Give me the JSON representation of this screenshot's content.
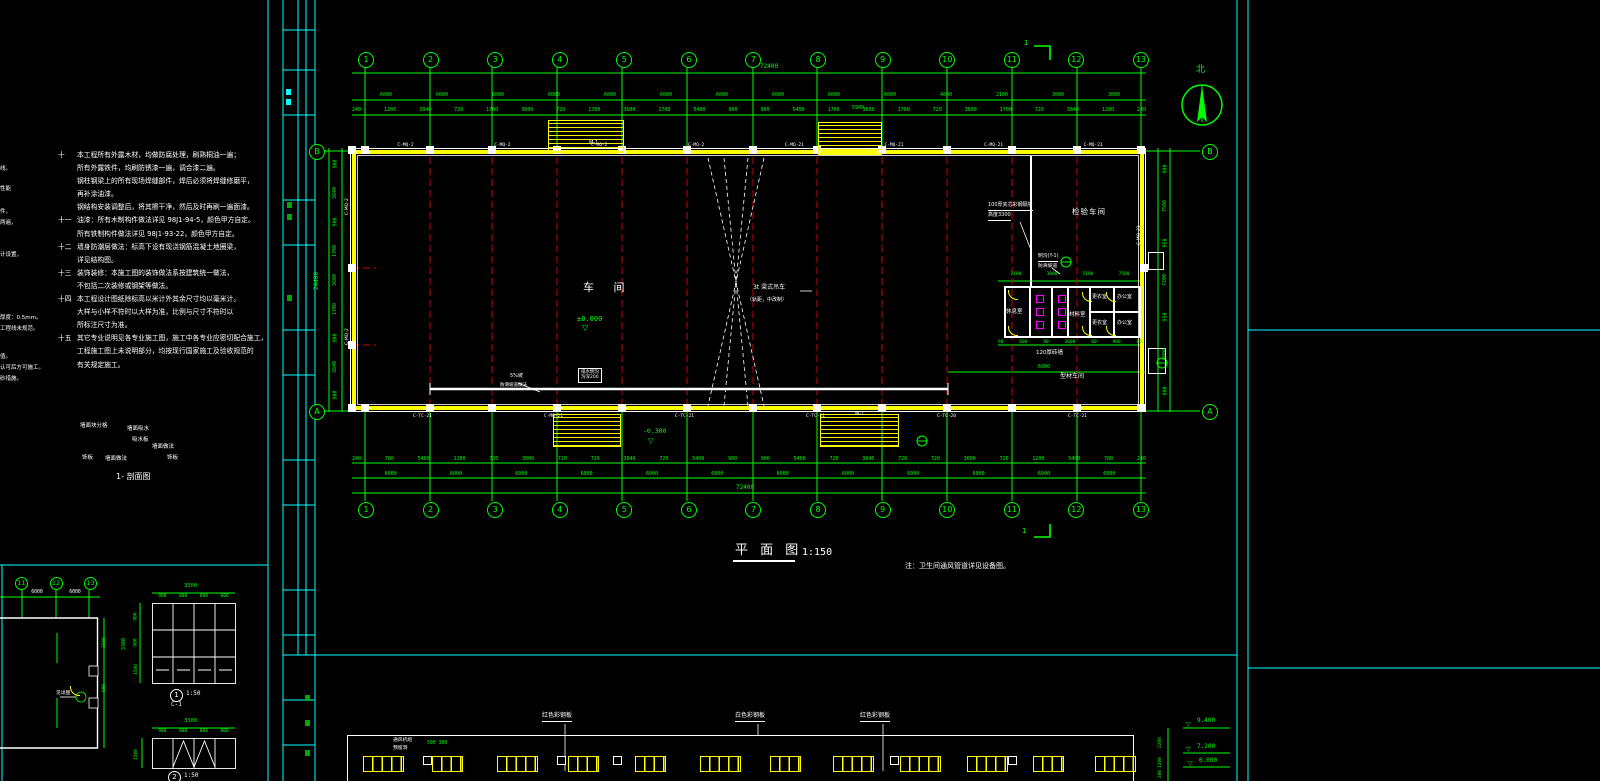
{
  "notes": [
    {
      "n": "十",
      "t": "本工程所有外露木材，均做防腐处理，刷熟桐油一遍；"
    },
    {
      "n": "",
      "t": "所有外露铁件，均刷防锈漆一遍，调合漆二遍。"
    },
    {
      "n": "",
      "t": "钢柱钢梁上的所有现场焊缝部件，焊后必须将焊缝修磨平，"
    },
    {
      "n": "",
      "t": "再补涂油漆。"
    },
    {
      "n": "",
      "t": "钢结构安装调整后，将其擦干净，然后及时再刷一遍面漆。"
    },
    {
      "n": "十一",
      "t": "油漆：所有木制构件做法详见 98J1-94-5，颜色甲方自定。"
    },
    {
      "n": "",
      "t": "所有铁制构件做法详见 98J1-93-22，颜色甲方自定。"
    },
    {
      "n": "十二",
      "t": "墙身防潮层做法：标高下设有现浇钢筋混凝土地圈梁，"
    },
    {
      "n": "",
      "t": "详见结构图。"
    },
    {
      "n": "十三",
      "t": "装饰装修：本施工图的装饰做法系按建筑统一做法，"
    },
    {
      "n": "",
      "t": "不包括二次装修或钢架等做法。"
    },
    {
      "n": "十四",
      "t": "本工程设计图纸除标高以米计外其余尺寸均以毫米计。"
    },
    {
      "n": "",
      "t": "大样与小样不符时以大样为准，比例与尺寸不符时以"
    },
    {
      "n": "",
      "t": "所标注尺寸为准。"
    },
    {
      "n": "十五",
      "t": "其它专业说明见各专业施工图，施工中各专业应密切配合施工，"
    },
    {
      "n": "",
      "t": "工程施工图上未说明部分，均按现行国家施工及验收规范的"
    },
    {
      "n": "",
      "t": "有关规定施工。"
    }
  ],
  "fragments": [
    "线。",
    "性能",
    "件，",
    "两遍，",
    "计设置，",
    "厚度：0.5mm。",
    "工程线未规范。",
    "值。",
    "认可后方可施工。",
    "砂措施。"
  ],
  "finish_labels": [
    "墙面块分格",
    "墙面吸水",
    "吸水板",
    "墙面做法",
    "饰板",
    "墙面做法",
    "饰板"
  ],
  "section_label": "1- 剖面图",
  "plan": {
    "grid_cols": [
      "1",
      "2",
      "3",
      "4",
      "5",
      "6",
      "7",
      "8",
      "9",
      "10",
      "11",
      "12",
      "13"
    ],
    "row_top": "B",
    "row_bottom": "A",
    "total_dim": "72400",
    "left_total": "24400",
    "stair_dim": "5900",
    "dims_top_major": [
      "6000",
      "6000",
      "6000",
      "6000",
      "6000",
      "6000",
      "6000",
      "6000",
      "6000",
      "6000",
      "4800",
      "2100",
      "3000",
      "3000"
    ],
    "dims_top_minor": [
      "240",
      "1200",
      "3840",
      "720",
      "1700",
      "3600",
      "720",
      "1700",
      "3600",
      "1700",
      "5400",
      "900",
      "900",
      "5400",
      "1700",
      "3600",
      "1700",
      "720",
      "3600",
      "1700",
      "720",
      "3840",
      "1200",
      "240"
    ],
    "dims_bottom_minor": [
      "240",
      "780",
      "5400",
      "1200",
      "720",
      "3600",
      "720",
      "720",
      "3840",
      "720",
      "5400",
      "900",
      "900",
      "5400",
      "720",
      "3840",
      "720",
      "720",
      "3600",
      "720",
      "1200",
      "5400",
      "780",
      "240"
    ],
    "dims_bottom_major": [
      "6000",
      "6000",
      "6000",
      "6000",
      "6000",
      "6000",
      "6000",
      "6000",
      "6000",
      "6000",
      "6000",
      "6000"
    ],
    "dims_left": [
      "900",
      "3840",
      "900",
      "1700",
      "3600",
      "1700",
      "900",
      "3840",
      "900"
    ],
    "dims_right": [
      "900",
      "7500",
      "950",
      "7200",
      "950",
      "6000",
      "900"
    ],
    "office_dims_top": [
      "2100",
      "3000",
      "5100",
      "7500"
    ],
    "office_dims_bottom": [
      "90",
      "600",
      "90",
      "3600",
      "60",
      "900",
      "60"
    ],
    "codes_top": [
      "C-MQ-2",
      "C-MQ-2",
      "C-MQ-2",
      "C-MQ-2",
      "C-MQ-21",
      "C-MQ-21",
      "C-MQ-21",
      "C-MQ-21"
    ],
    "codes_bottom": [
      "C-TC-21",
      "C-MQ-21",
      "C-TC-21",
      "C-TC-21",
      "C-TC-20",
      "C-TC-21"
    ],
    "codes_left": [
      "C-MQ-2",
      "C-MQ-2"
    ],
    "code_right": "C-MQ-21",
    "labels": {
      "workshop": "车 间",
      "inspection": "检验车间",
      "rest": "休息室",
      "material": "材料室",
      "change": "更衣室",
      "office": "办公室",
      "brick_wall": "120厚砖墙",
      "partition_l1": "100厚夹芯彩钢隔墙",
      "partition_l2": "高度3300",
      "gutter_l1": "明沟(Y-1)",
      "gutter_l2": "防滑坡道",
      "crane_l1": "3t 梁式吊车",
      "crane_l2": "（轨距，中改制）",
      "ramp_l1": "5%坡",
      "ramp_l2": "防滑坡道做法",
      "trench_l1": "排水明沟",
      "trench_l2": "沟深200",
      "profile_shop": "型材车间",
      "inner_dim": "6000",
      "level_zero": "±0.000",
      "level_neg": "-0.300",
      "door": "M-1",
      "section_num": "1",
      "tri": "▽"
    }
  },
  "title": {
    "text": "平 面 图",
    "scale": "1:150"
  },
  "side_note": "注：卫生间通风管道详见设备图。",
  "compass": {
    "label": "北"
  },
  "elevation": {
    "panel_labels": [
      "红色彩钢板",
      "白色彩钢板",
      "红色彩钢板"
    ],
    "vent_l1": "通风机组",
    "vent_l2": "预留洞",
    "vent_dims": "500 300",
    "levels": [
      "9.400",
      "7.200",
      "6.000"
    ],
    "side_dims": [
      "2200",
      "1200",
      "200"
    ],
    "window_groups": [
      4,
      3,
      4,
      3,
      3,
      4,
      3,
      4,
      4,
      3,
      4
    ]
  },
  "details": {
    "small_plan": {
      "grids": [
        "11",
        "12",
        "13"
      ],
      "dims": [
        "6000",
        "6000"
      ],
      "side_dims": [
        "3600",
        "900"
      ],
      "note": "见详图"
    },
    "win1": {
      "num": "1",
      "scale": "1:50",
      "code": "C-1",
      "w_total": "3300",
      "w_segs": [
        "900",
        "800",
        "800",
        "800"
      ],
      "h_segs": [
        "900",
        "900",
        "1500"
      ],
      "h_total": "3300"
    },
    "win2": {
      "num": "2",
      "scale": "1:50",
      "w_total": "3300",
      "w_segs": [
        "900",
        "800",
        "800",
        "800"
      ],
      "h_seg": "1500"
    }
  }
}
